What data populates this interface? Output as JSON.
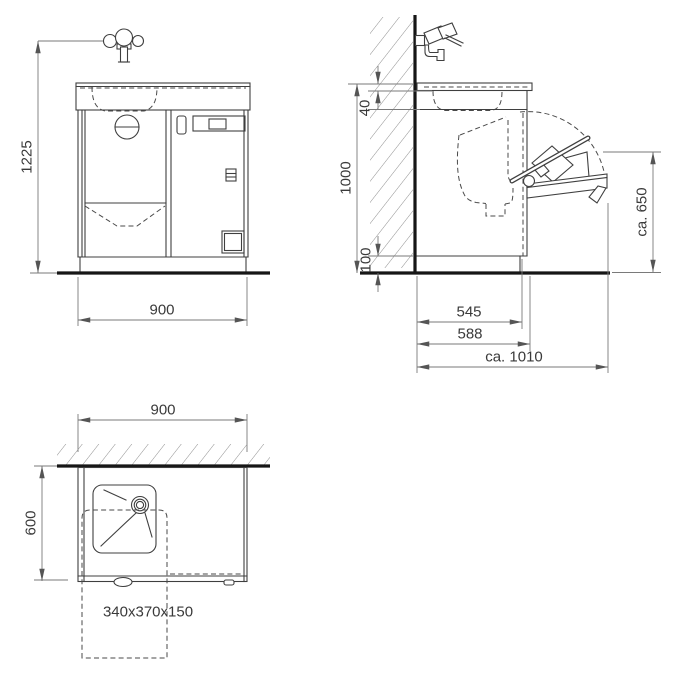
{
  "dimensions": {
    "front": {
      "height": "1225",
      "width": "900"
    },
    "side": {
      "worktop_thickness": "40",
      "height": "1000",
      "plinth_height": "100",
      "table_height": "ca. 650",
      "depth_inner": "545",
      "depth_body": "588",
      "depth_open": "ca. 1010"
    },
    "plan": {
      "width": "900",
      "depth": "600",
      "basin_size": "340x370x150"
    }
  },
  "colors": {
    "background": "#ffffff",
    "line": "#3f3f3f",
    "heavy_line": "#161616",
    "dimension_line": "#7a7a7a",
    "text": "#3a3a3a"
  }
}
